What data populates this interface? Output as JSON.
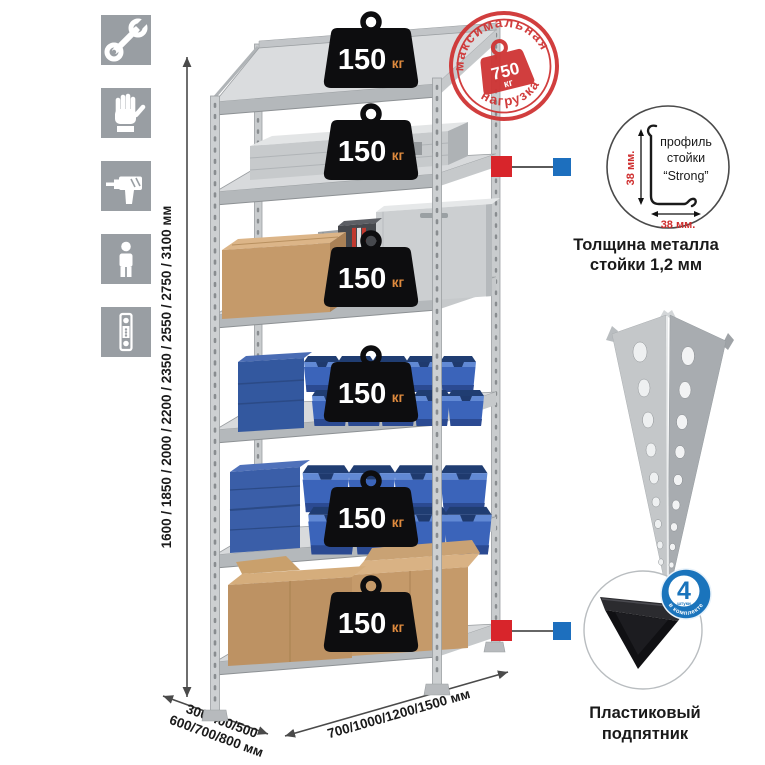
{
  "page": {
    "background": "#ffffff"
  },
  "sidebar": {
    "icons": [
      {
        "name": "wrench-icon"
      },
      {
        "name": "work-gloves-icon"
      },
      {
        "name": "drill-icon"
      },
      {
        "name": "person-icon"
      },
      {
        "name": "rack-post-profile-icon"
      }
    ]
  },
  "rack": {
    "weights": [
      {
        "value": "150",
        "unit": "кг"
      },
      {
        "value": "150",
        "unit": "кг"
      },
      {
        "value": "150",
        "unit": "кг"
      },
      {
        "value": "150",
        "unit": "кг"
      },
      {
        "value": "150",
        "unit": "кг"
      },
      {
        "value": "150",
        "unit": "кг"
      }
    ],
    "dimensions": {
      "height": "1600 / 1850 / 2000 / 2200 / 2350 / 2550 / 2750 / 3100 мм",
      "depth_line1": "300/400/500",
      "depth_line2": "600/700/800 мм",
      "width": "700/1000/1200/1500 мм"
    }
  },
  "stamp": {
    "arc_top": "максимальная",
    "arc_bottom": "нагрузка",
    "value": "750",
    "unit": "кг"
  },
  "profile_callout": {
    "label_line1": "профиль",
    "label_line2": "стойки",
    "label_line3": "“Strong”",
    "dim_vertical": "38 мм.",
    "dim_horizontal": "38 мм.",
    "caption_line1": "Толщина металла",
    "caption_line2": "стойки 1,2 мм"
  },
  "foot_callout": {
    "badge_value": "4",
    "badge_small": "штуки",
    "badge_arc": "в комплекте",
    "caption_line1": "Пластиковый",
    "caption_line2": "подпятник"
  },
  "colors": {
    "accent_red": "#cf3434",
    "accent_blue": "#1a74bc",
    "bin_blue": "#3b64ba",
    "metal_gray": "#c9ccce",
    "cardboard": "#c59a6a",
    "icon_gray": "#999ea3"
  }
}
